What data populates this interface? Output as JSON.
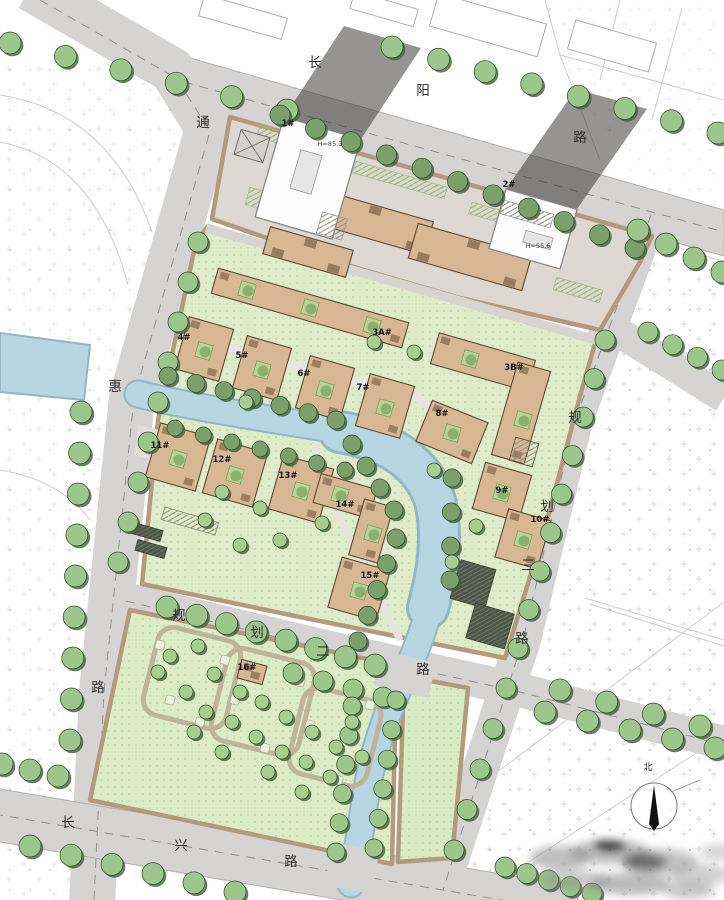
{
  "palette": {
    "road": "#d6d3d3",
    "road_edge": "#b2afac",
    "site_commercial": "#ddd8d1",
    "site_residential": "#dfecca",
    "site_park": "#dcedc6",
    "site_park_east": "#d9ebc3",
    "site_border": "#b49a7c",
    "water": "#b6d7e2",
    "water_bank": "#92b7c4",
    "tree": "#9cc68b",
    "tree_dark": "#7ba06c",
    "tree_light": "#a8cd90",
    "tree_shadow": "#41603a",
    "building": "#d8b795",
    "building_stroke": "#5d4a35",
    "building_unit": "#8f7557",
    "tower": "#fdfdfd",
    "tower_stroke": "#878787",
    "shadow": "rgba(52,50,46,0.52)",
    "garage": "#4e5447",
    "courtyard": "#b7d494",
    "park_path": "#bfb39a"
  },
  "roads": [
    {
      "id": "changyang",
      "name": "长阳路",
      "chars": [
        {
          "ch": "长",
          "x": 315,
          "y": 63
        },
        {
          "ch": "阳",
          "x": 423,
          "y": 91
        },
        {
          "ch": "路",
          "x": 580,
          "y": 138
        }
      ]
    },
    {
      "id": "tonghui",
      "name": "通惠路",
      "chars": [
        {
          "ch": "通",
          "x": 203,
          "y": 123
        },
        {
          "ch": "惠",
          "x": 115,
          "y": 387
        },
        {
          "ch": "路",
          "x": 98,
          "y": 688
        }
      ]
    },
    {
      "id": "changxing",
      "name": "长兴路",
      "chars": [
        {
          "ch": "长",
          "x": 68,
          "y": 823
        },
        {
          "ch": "兴",
          "x": 181,
          "y": 846
        },
        {
          "ch": "路",
          "x": 291,
          "y": 862
        }
      ]
    },
    {
      "id": "guihua-2",
      "name": "规划二路",
      "chars": [
        {
          "ch": "规",
          "x": 179,
          "y": 616
        },
        {
          "ch": "划",
          "x": 257,
          "y": 633
        },
        {
          "ch": "二",
          "x": 323,
          "y": 652
        },
        {
          "ch": "路",
          "x": 423,
          "y": 670
        }
      ]
    },
    {
      "id": "guihua-3",
      "name": "规划三路",
      "chars": [
        {
          "ch": "规",
          "x": 575,
          "y": 418
        },
        {
          "ch": "划",
          "x": 547,
          "y": 507
        },
        {
          "ch": "三",
          "x": 528,
          "y": 566
        },
        {
          "ch": "路",
          "x": 522,
          "y": 639
        }
      ]
    }
  ],
  "buildings": [
    {
      "label": "1#",
      "x": 288,
      "y": 124
    },
    {
      "label": "2#",
      "x": 509,
      "y": 185
    },
    {
      "label": "3A#",
      "x": 382,
      "y": 333
    },
    {
      "label": "3B#",
      "x": 514,
      "y": 368
    },
    {
      "label": "4#",
      "x": 184,
      "y": 338
    },
    {
      "label": "5#",
      "x": 242,
      "y": 356
    },
    {
      "label": "6#",
      "x": 304,
      "y": 374
    },
    {
      "label": "7#",
      "x": 363,
      "y": 388
    },
    {
      "label": "8#",
      "x": 442,
      "y": 414
    },
    {
      "label": "9#",
      "x": 502,
      "y": 491
    },
    {
      "label": "10#",
      "x": 540,
      "y": 520
    },
    {
      "label": "11#",
      "x": 160,
      "y": 446
    },
    {
      "label": "12#",
      "x": 222,
      "y": 460
    },
    {
      "label": "13#",
      "x": 288,
      "y": 476
    },
    {
      "label": "14#",
      "x": 345,
      "y": 505
    },
    {
      "label": "15#",
      "x": 370,
      "y": 576
    },
    {
      "label": "16#",
      "x": 247,
      "y": 668
    }
  ],
  "annotations": [
    {
      "text": "H=85.3",
      "x": 330,
      "y": 144
    },
    {
      "text": "H=55.6",
      "x": 538,
      "y": 246
    }
  ],
  "compass": {
    "label": "北",
    "x": 654,
    "y": 806
  }
}
